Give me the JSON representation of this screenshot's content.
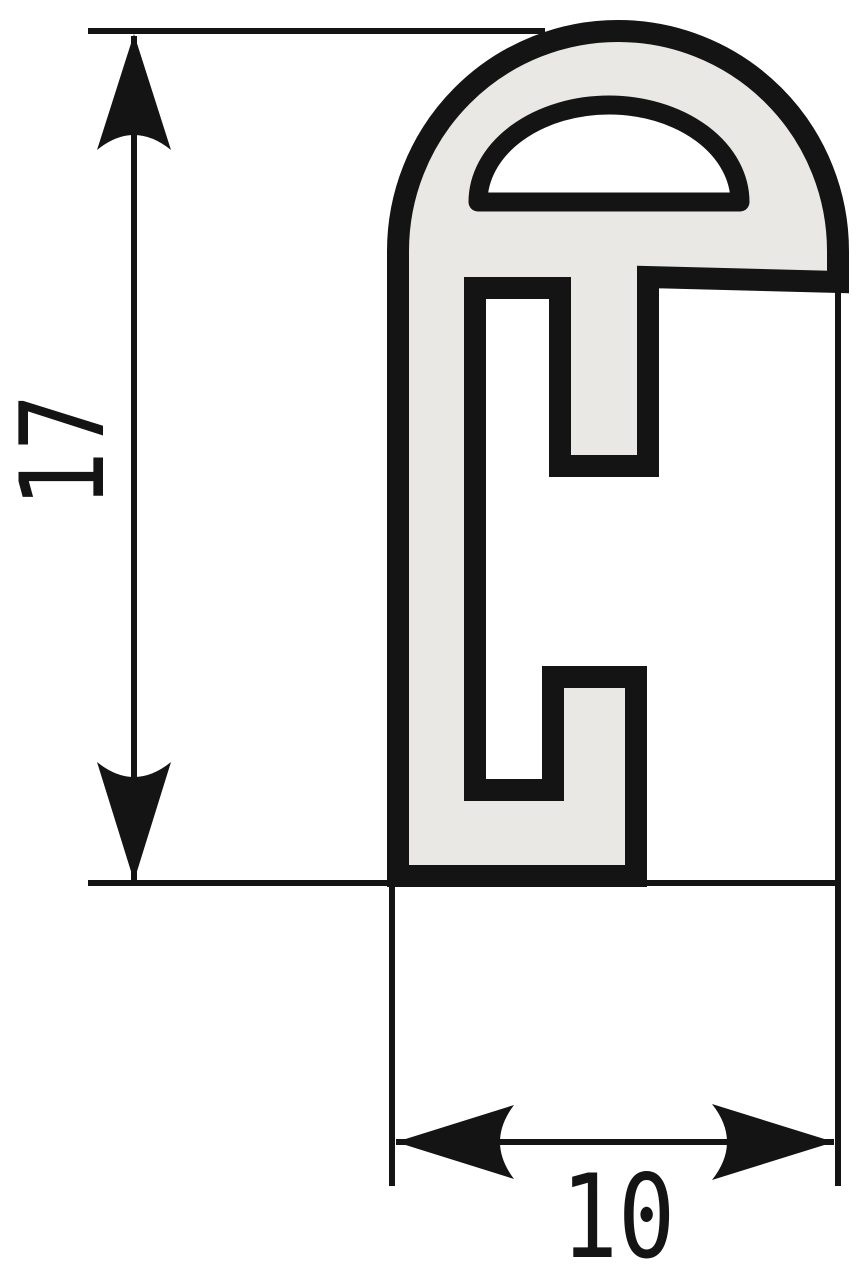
{
  "drawing": {
    "kind": "extrusion-profile-cross-section",
    "height_label": "17",
    "width_label": "10",
    "colors": {
      "line": "#141414",
      "profile_fill": "#e9e8e5",
      "background": "#ffffff"
    }
  }
}
